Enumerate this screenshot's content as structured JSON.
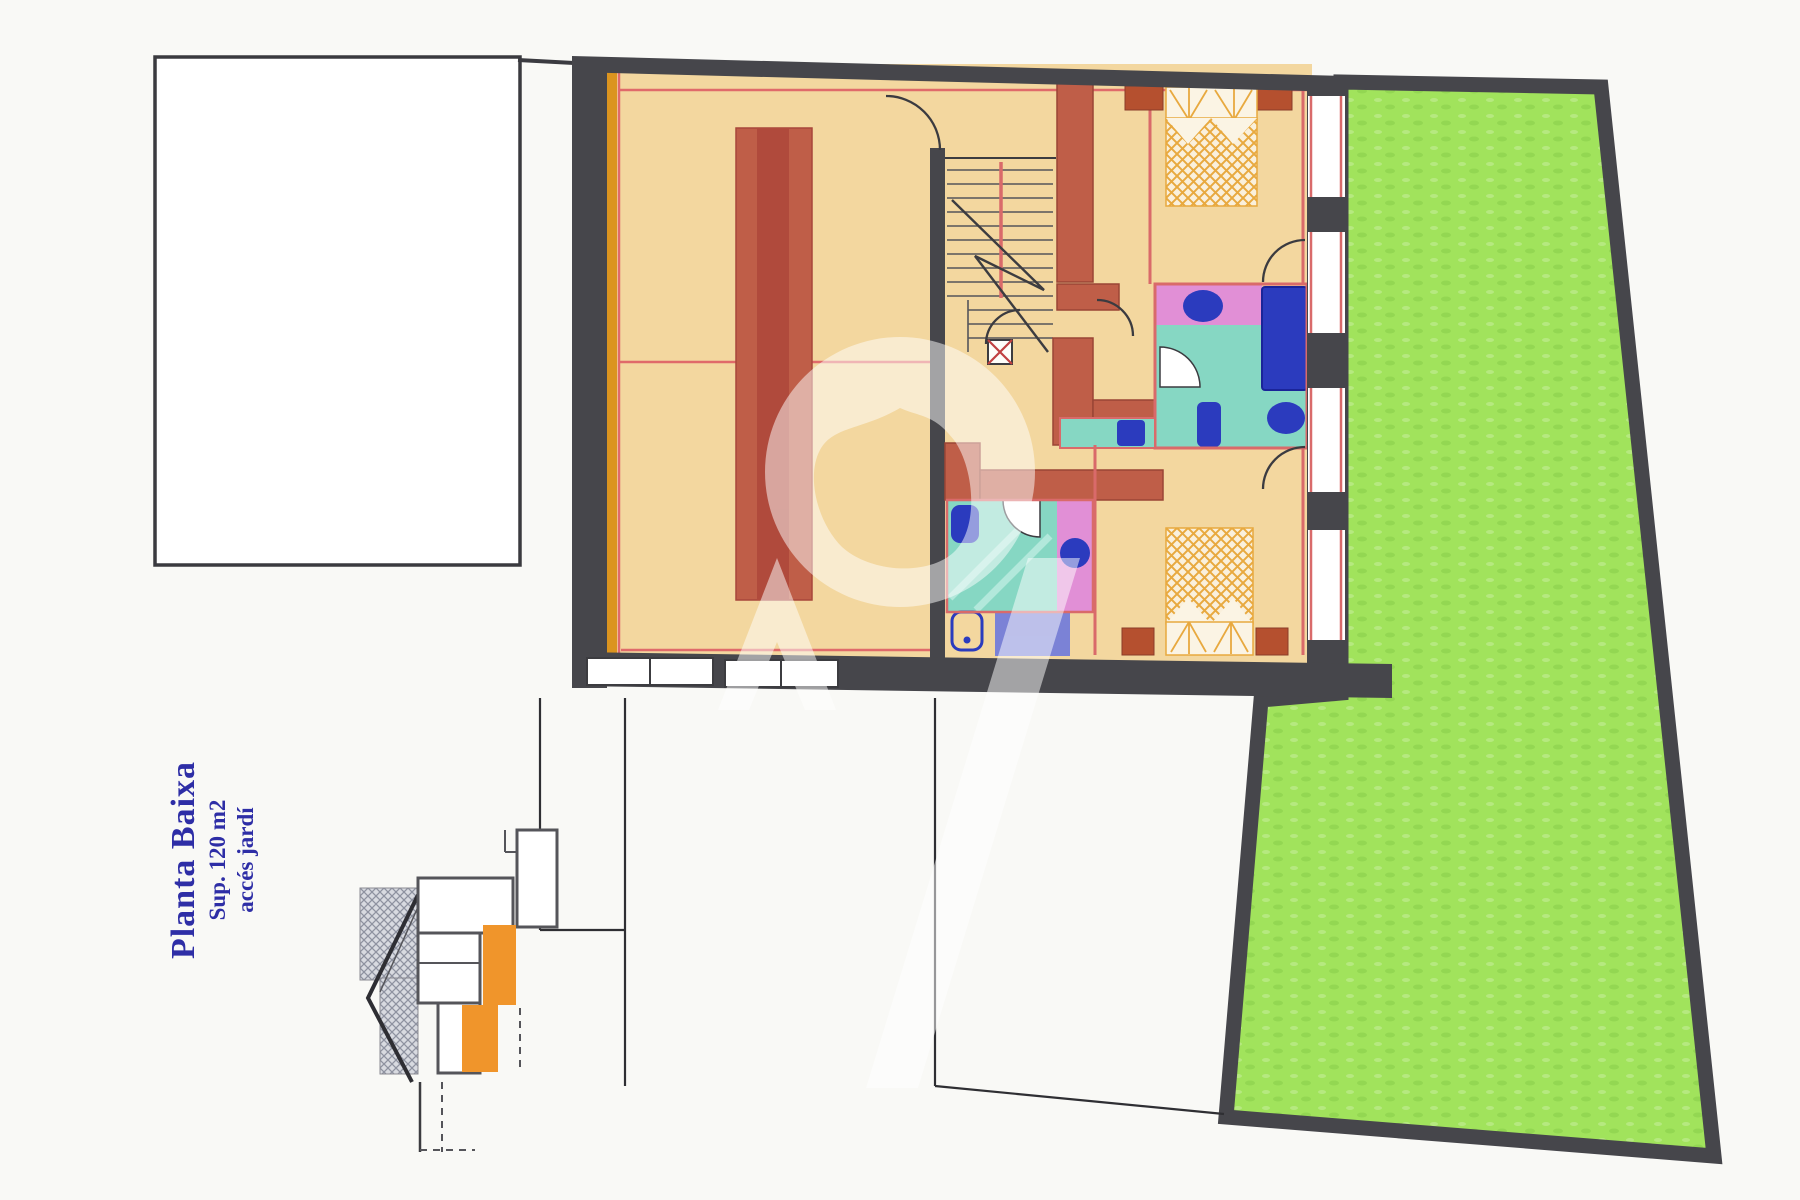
{
  "document": {
    "kind": "scanned floor plan",
    "floor_label": "Planta Baixa",
    "area_label": "Sup. 120 m2",
    "access_label": "accés jardí"
  },
  "colors": {
    "paper": "#F9F9F6",
    "wall_dark": "#46464B",
    "floor_tan": "#F3D79F",
    "accent_orange": "#DB941F",
    "section_orange": "#F0952B",
    "furniture_red": "#BF5E48",
    "furniture_red_dark": "#B04A3C",
    "inner_line_red": "#D96A6A",
    "garden_green": "#A1E35C",
    "bath_teal": "#86D7C3",
    "bath_pink": "#E18FD6",
    "fixture_blue": "#2B3BBE",
    "fixture_periwinkle": "#7B82D6",
    "bed_hatch_orange": "#E8A93F",
    "label_blue": "#2E2EA6",
    "watermark_white": "rgba(255,255,255,0.5)"
  }
}
